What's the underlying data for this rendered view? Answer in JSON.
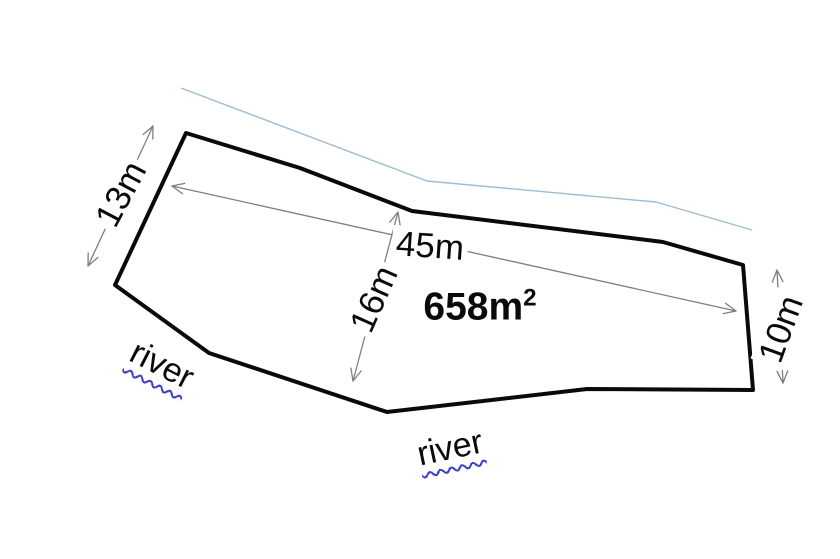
{
  "diagram": {
    "canvas": {
      "width": 840,
      "height": 559
    },
    "colors": {
      "background": "#ffffff",
      "outline": "#0a0a0a",
      "dimension": "#7f7f7f",
      "river_line": "#9fbbd0",
      "squiggle": "#3c3cc8",
      "text": "#0a0a0a"
    },
    "outline_points": [
      [
        186,
        133
      ],
      [
        300,
        168
      ],
      [
        412,
        211
      ],
      [
        663,
        242
      ],
      [
        743,
        265
      ],
      [
        753,
        390
      ],
      [
        587,
        389
      ],
      [
        387,
        412
      ],
      [
        209,
        353
      ],
      [
        115,
        285
      ]
    ],
    "river_line_points": [
      [
        181,
        88
      ],
      [
        427,
        181
      ],
      [
        656,
        202
      ],
      [
        752,
        230
      ]
    ],
    "dimensions": [
      {
        "label": "13m",
        "from": [
          153,
          126
        ],
        "to": [
          88,
          266
        ],
        "pos": [
          121,
          194
        ],
        "rot": -62
      },
      {
        "label": "45m",
        "from": [
          172,
          186
        ],
        "to": [
          736,
          311
        ],
        "pos": [
          430,
          246
        ],
        "rot": 4
      },
      {
        "label": "16m",
        "from": [
          398,
          212
        ],
        "to": [
          353,
          381
        ],
        "pos": [
          374,
          299
        ],
        "rot": -66
      },
      {
        "label": "10m",
        "from": [
          777,
          270
        ],
        "to": [
          783,
          383
        ],
        "pos": [
          781,
          329
        ],
        "rot": -70
      }
    ],
    "area_label": {
      "text": "658m",
      "sup": "2",
      "pos": [
        480,
        307
      ],
      "rot": 0
    },
    "river_labels": [
      {
        "text": "river",
        "pos": [
          162,
          365
        ],
        "rot": 27
      },
      {
        "text": "river",
        "pos": [
          450,
          448
        ],
        "rot": -12
      }
    ]
  }
}
